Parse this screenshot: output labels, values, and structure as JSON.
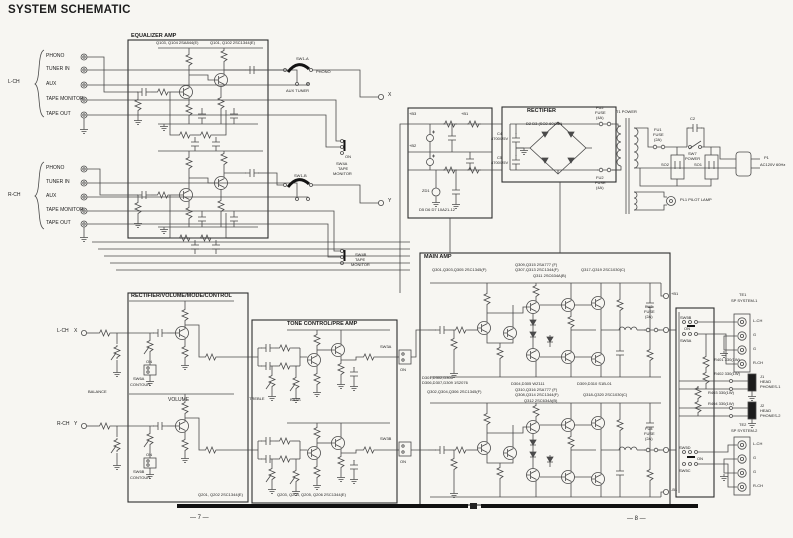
{
  "page": {
    "title": "SYSTEM SCHEMATIC",
    "page_left": "— 7 —",
    "page_right": "— 8 —"
  },
  "inputs": {
    "l_channel": "L-CH",
    "r_channel": "R-CH",
    "l": [
      "PHONO",
      "TUNER IN",
      "AUX",
      "TAPE MONITOR",
      "TAPE OUT"
    ],
    "r": [
      "PHONO",
      "TUNER IN",
      "AUX",
      "TAPE MONITOR",
      "TAPE OUT"
    ]
  },
  "equalizer": {
    "title": "EQUALIZER AMP",
    "parts_a": "Q103, Q104  2SA844(E)",
    "parts_b": "Q101, Q102  2SC1344(E)"
  },
  "selector": {
    "sw1a": "SW1-A",
    "sw1b": "SW1-B",
    "phono": "PHONO",
    "aux_tuner": "AUX TUNER",
    "sw4a": "SW4A",
    "sw4b": "SW4B",
    "tape": "TAPE",
    "monitor": "MONITOR",
    "on": "ON",
    "x": "X",
    "y": "Y"
  },
  "power_filter": {
    "b1": "+B1",
    "b2": "+B2",
    "b3": "+B3",
    "zd1": "ZD1",
    "parts": "D5 D6 D7  10A21-12"
  },
  "rectifier": {
    "title": "RECTIFIER",
    "parts": "D2 D3  (SO2-60)25N",
    "c4": "C4",
    "c4v": "4700/25V",
    "c5": "C5",
    "c5v": "4700/25V",
    "fu2": "FU2",
    "fuse": "FUSE",
    "amp4": "(4A)"
  },
  "power": {
    "t1": "T1 POWER",
    "fu1": "FU1",
    "fuse": "FUSE",
    "amp2": "(2A)",
    "c2": "C2",
    "sw7": "SW7",
    "sw7_sub": "POWER",
    "so1": "SO1",
    "so2": "SO2",
    "p1": "P1",
    "p1_sub": "AC120V 60Hz",
    "pl1": "PL1 PILOT LAMP"
  },
  "volume": {
    "title": "RECTIFIER/VOLUME/MODE/CONTROL",
    "balance": "BALANCE",
    "volume": "VOLUME",
    "on": "ON",
    "sw6a": "SW6A",
    "sw6b": "SW6B",
    "contour": "CONTOUR",
    "parts": "Q201, Q202  2SC1344(E)",
    "l": "L-CH",
    "r": "R-CH",
    "x": "X",
    "y": "Y"
  },
  "tone": {
    "title": "TONE CONTROL/PRE AMP",
    "treble": "TREBLE",
    "bass": "BASS",
    "parts": "Q203, Q204, Q205, Q206  2SC1344(E)"
  },
  "filter_sw": {
    "sw3a": "SW3A",
    "sw3b": "SW3B",
    "on": "ON"
  },
  "main": {
    "title": "MAIN AMP",
    "t1": "Q301,Q303,Q305  2SC1345(F)",
    "t2": "Q309,Q315  2SA777 (F)",
    "t3": "Q307,Q313  2SC1344(F)",
    "t4": "Q311  2SC634A(B)",
    "t5": "Q317-Q319  2SC1030(C)",
    "b1": "D301,D302,D305",
    "b2": "D306,D307,D309  1S2076",
    "b3": "D304,D305  WZ111",
    "b4": "D309,D310  S1B-01",
    "b5": "Q302,Q304,Q306  2SC1345(F)",
    "b6": "Q310,Q316  2SA777 (F)",
    "b7": "Q308,Q314  2SC1344(F)",
    "b8": "Q312  2SC634A(B)",
    "b9": "Q318-Q320  2SC1030(C)",
    "fu3": "FU3",
    "fu4": "FU4",
    "fuse": "FUSE",
    "amp2": "(2A)",
    "bp": "+B1",
    "bn": "-B1"
  },
  "speaker": {
    "sw5a": "SW5A",
    "sw5b": "SW5B",
    "sw5c": "SW5C",
    "sw5d": "SW5D",
    "on": "ON",
    "r401": "R401 330(1W)",
    "r402": "R402 330(1W)",
    "r403": "R403 330(1W)",
    "r404": "R404 330(1W)",
    "te1": "TE1",
    "sys1": "SP SYSTEM-1",
    "te2": "TE2",
    "sys2": "SP SYSTEM-2",
    "lch": "L-CH",
    "g": "G",
    "rch": "R-CH",
    "j1": "J1",
    "j2": "J2",
    "head": "HEAD",
    "phones1": "PHONES-1",
    "phones2": "PHONES-2"
  }
}
